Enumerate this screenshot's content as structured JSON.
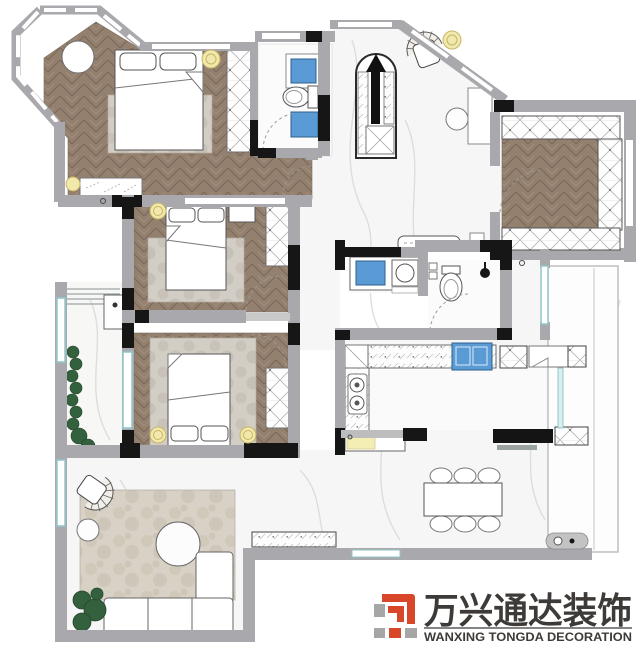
{
  "logo": {
    "cn": "万兴通达装饰",
    "en": "WANXING TONGDA DECORATION"
  },
  "colors": {
    "wall_gray": "#a9a9ad",
    "wall_black": "#161616",
    "wood": "#94806f",
    "marble": "#f6f6f7",
    "glass_teal": "#8fc7c9",
    "fixture_blue": "#5b9bd5",
    "light_yellow": "#f1e8ab",
    "plant_green": "#33603d",
    "rug_beige": "#d8d2c6",
    "logo_red": "#d9472b",
    "logo_gray": "#a6a6a6",
    "logo_text": "#3d3a37"
  }
}
